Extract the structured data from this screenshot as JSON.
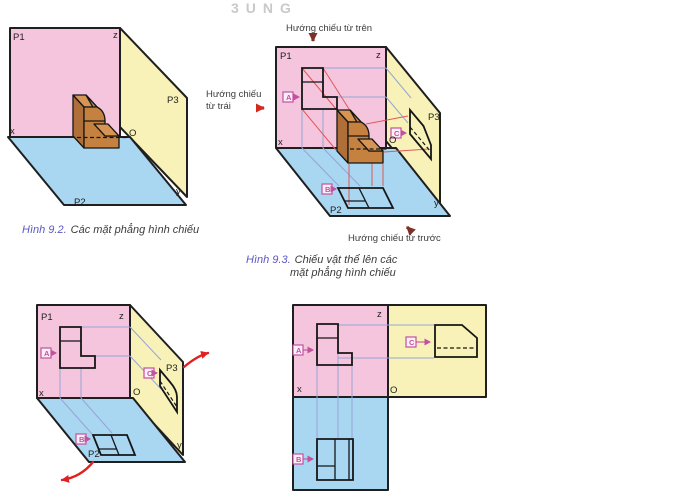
{
  "watermark": "3UNG",
  "labels": {
    "p1": "P1",
    "p2": "P2",
    "p3": "P3",
    "x": "x",
    "y": "y",
    "z": "z",
    "o": "O",
    "a": "A",
    "b": "B",
    "c": "C"
  },
  "annotations": {
    "top_direction": "Hướng chiếu từ trên",
    "left_direction_line1": "Hướng chiếu",
    "left_direction_line2": "từ trái",
    "front_direction": "Hướng chiếu từ trước"
  },
  "captions": {
    "fig92_label": "Hình 9.2.",
    "fig92_text": "Các mặt phẳng hình chiếu",
    "fig93_label": "Hình 9.3.",
    "fig93_line1": "Chiếu vật thể lên các",
    "fig93_line2": "mặt phẳng hình chiếu"
  },
  "colors": {
    "plane_p1_pink": "#F4C5DC",
    "plane_p2_blue": "#A9D6F1",
    "plane_p3_yellow": "#F8F2B8",
    "object_top": "#D79553",
    "object_front": "#C5813F",
    "object_side": "#B06F38",
    "projection_ray_red": "#E05858",
    "construction_blue": "#96A5D6",
    "label_box_magenta": "#C2519F",
    "direction_arrow_red": "#D42A1E",
    "direction_arrow_maroon": "#7E2F26",
    "rotation_arrow_red": "#E02020",
    "caption_accent": "#5B57C5",
    "text_dark": "#3B3B3B"
  }
}
